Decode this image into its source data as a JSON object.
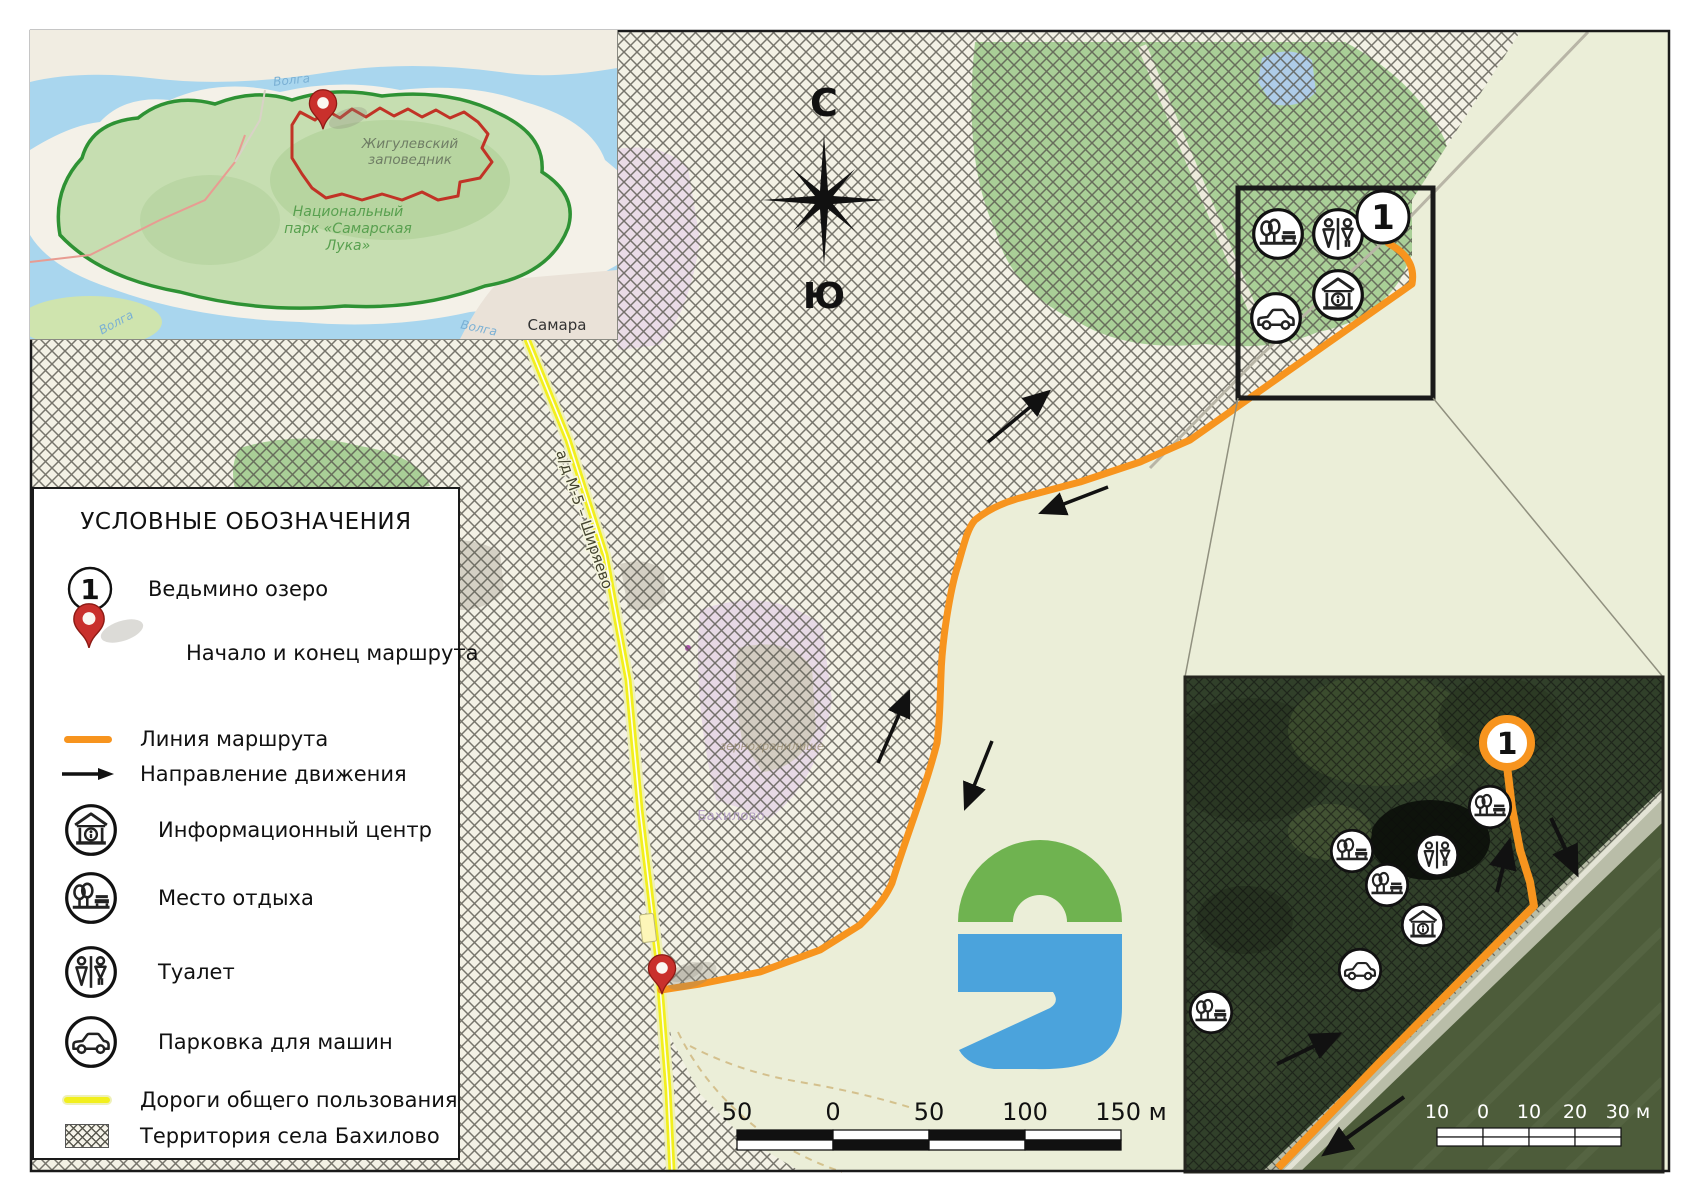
{
  "overview_map": {
    "reserve_line1": "Жигулевский",
    "reserve_line2": "заповедник",
    "park_line1": "Национальный",
    "park_line2": "парк «Самарская",
    "park_line3": "Лука»",
    "volga_top": "Волга",
    "volga_left": "Волга",
    "volga_right": "Волга",
    "city": "Самара"
  },
  "compass": {
    "north": "С",
    "south": "Ю"
  },
  "legend": {
    "title": "УСЛОВНЫЕ ОБОЗНАЧЕНИЯ",
    "point_marker": "1",
    "items": [
      {
        "label": "Ведьмино озеро"
      },
      {
        "label": "Начало и конец маршрута"
      },
      {
        "label": "Линия маршрута"
      },
      {
        "label": "Направление движения"
      },
      {
        "label": "Информационный центр"
      },
      {
        "label": "Место отдыха"
      },
      {
        "label": "Туалет"
      },
      {
        "label": "Парковка для машин"
      },
      {
        "label": "Дороги общего пользования"
      },
      {
        "label": "Территория села Бахилово"
      }
    ]
  },
  "main_map": {
    "point_marker": "1",
    "road_label": "а/д М-5 – Ширяево",
    "village_label": "Бахилово",
    "barn_label": "зернохранилище",
    "scale_labels": [
      "50",
      "0",
      "50",
      "100",
      "150 м"
    ]
  },
  "detail_inset": {
    "point_marker": "1",
    "scale_labels": [
      "10",
      "0",
      "10",
      "20",
      "30 м"
    ]
  },
  "colors": {
    "route": "#F7941E",
    "public_road": "#F2EF1D",
    "forest": "#A9CF97",
    "field": "#EBEED8",
    "logo_green": "#6FB350",
    "logo_blue": "#4BA3DC"
  }
}
